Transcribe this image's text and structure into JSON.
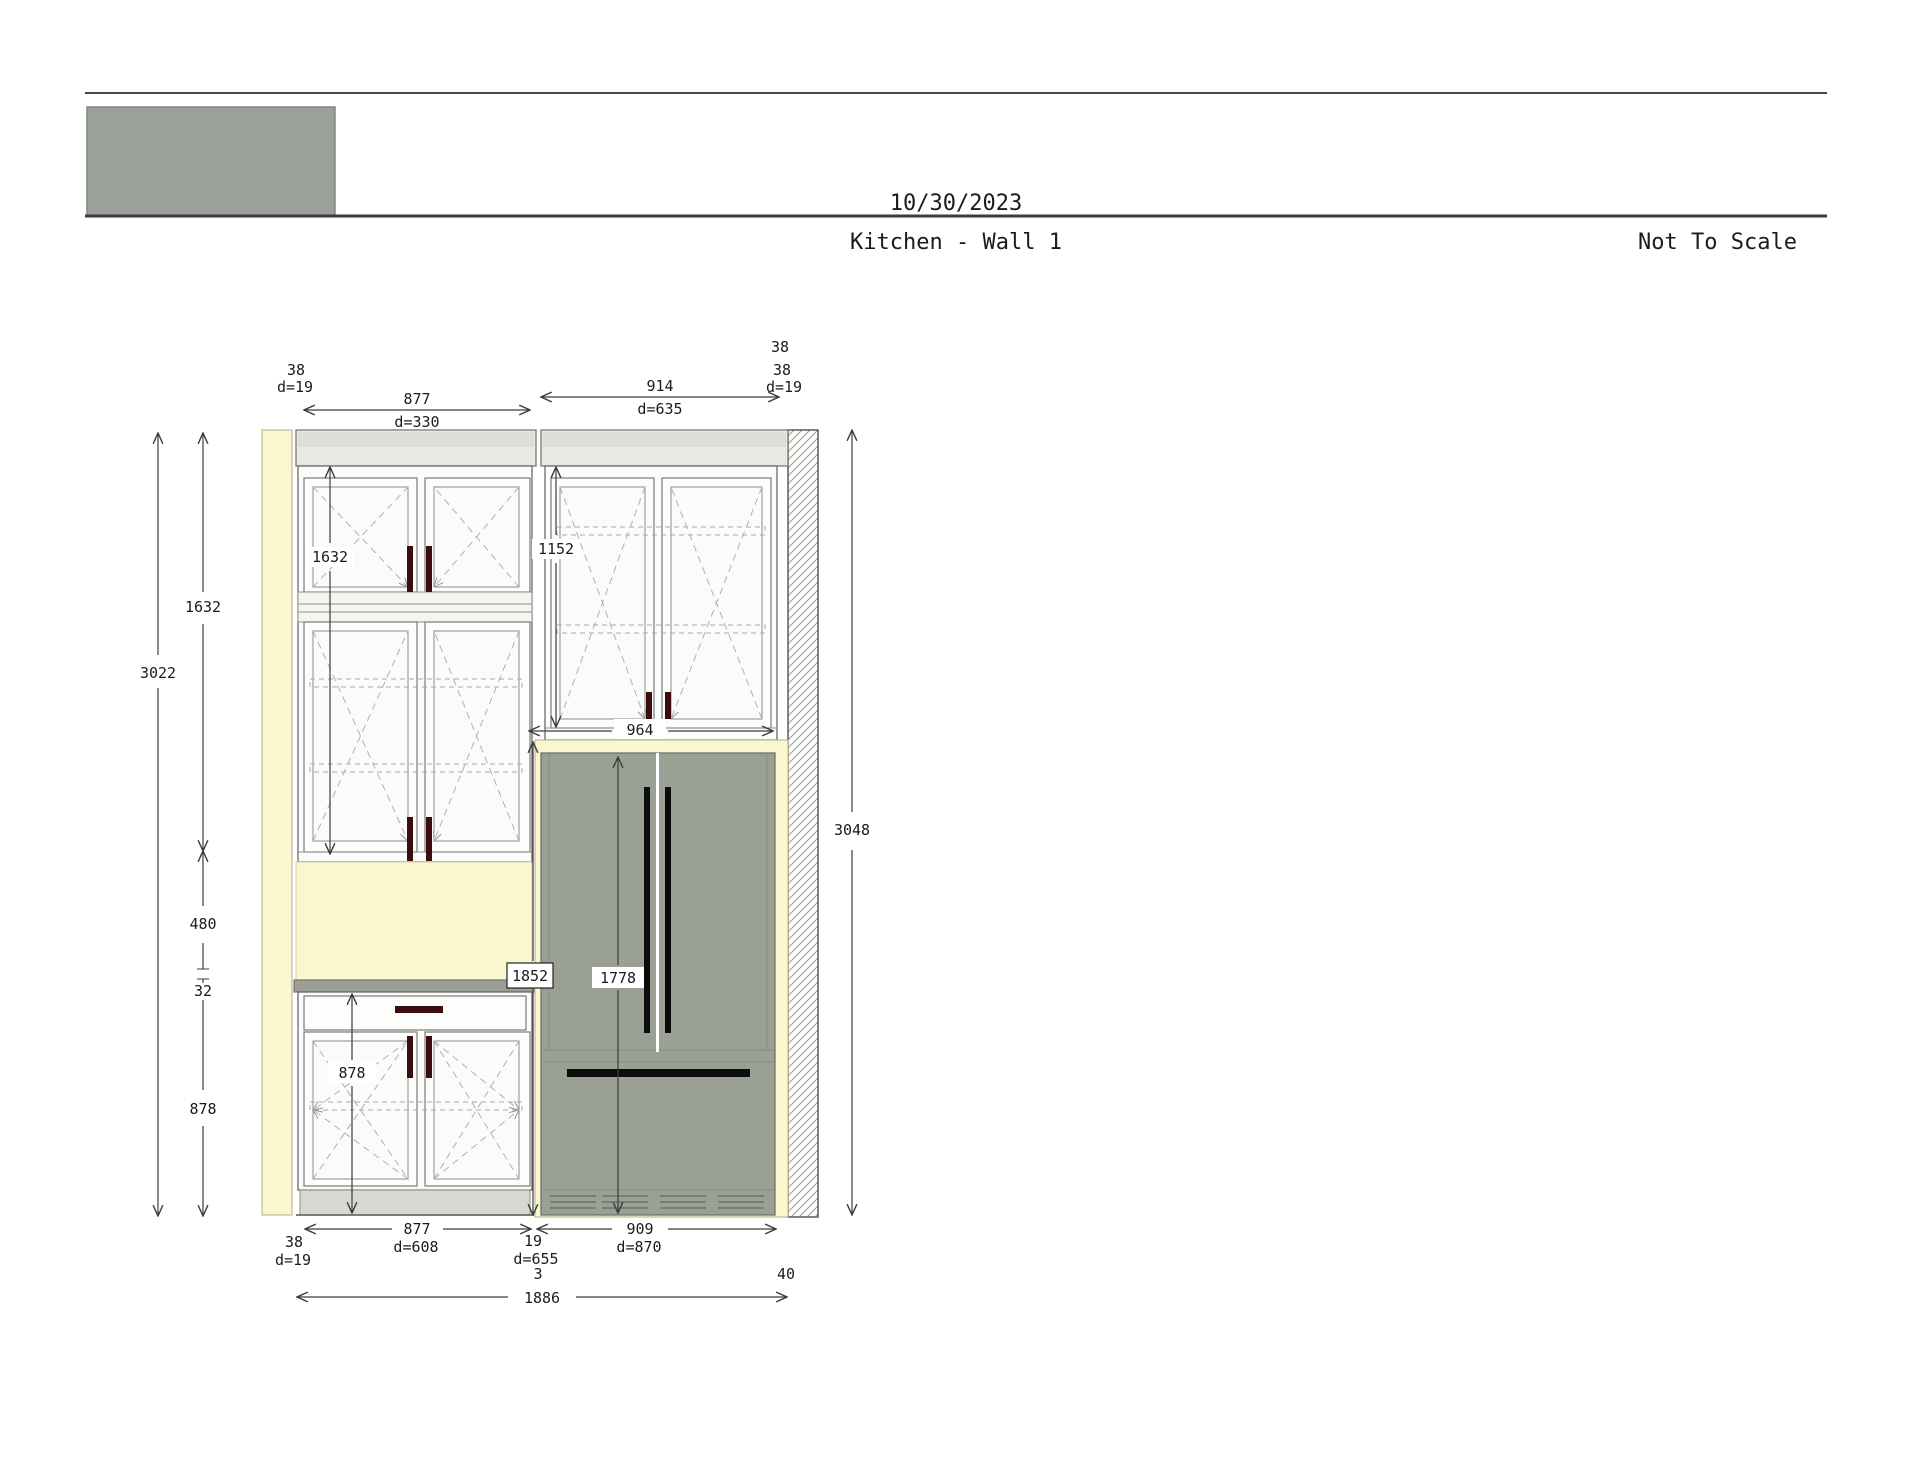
{
  "header": {
    "date": "10/30/2023",
    "title": "Kitchen - Wall 1",
    "scale_note": "Not To Scale"
  },
  "drawing": {
    "dims_top": {
      "left_filler": {
        "width": "38",
        "depth": "d=19"
      },
      "tall_cabinet": {
        "width": "877",
        "depth": "d=330"
      },
      "upper_cabinet": {
        "width": "914",
        "depth": "d=635"
      },
      "right_filler": {
        "width_a": "38",
        "width_b": "38",
        "depth": "d=19"
      }
    },
    "dims_left": {
      "total": "3022",
      "upper": "1632",
      "gap": "480",
      "countertop": "32",
      "base": "878"
    },
    "dims_right": {
      "total": "3048"
    },
    "dims_inner": {
      "tall_upper_height": "1632",
      "upper_cab_height": "1152",
      "opening_width": "964",
      "enclosure_height": "1852",
      "fridge_height": "1778",
      "base_height": "878"
    },
    "dims_bottom": {
      "left_filler": {
        "width": "38",
        "depth": "d=19"
      },
      "base_cabinet": {
        "width": "877",
        "depth": "d=608"
      },
      "mid_filler": {
        "width": "19",
        "depth": "d=655",
        "note": "3"
      },
      "fridge_opening": {
        "width": "909",
        "depth": "d=870"
      },
      "right_filler": "40",
      "total": "1886"
    }
  },
  "colors": {
    "wall_yellow": "#faf7d0",
    "fridge_gray": "#9aa094",
    "logo_gray": "#9aa19b",
    "handle_dark": "#3b0d0d",
    "handle_black": "#0c0c0c",
    "counter_gray": "#9d9e96",
    "toekick_gray": "#d8d8d2"
  }
}
